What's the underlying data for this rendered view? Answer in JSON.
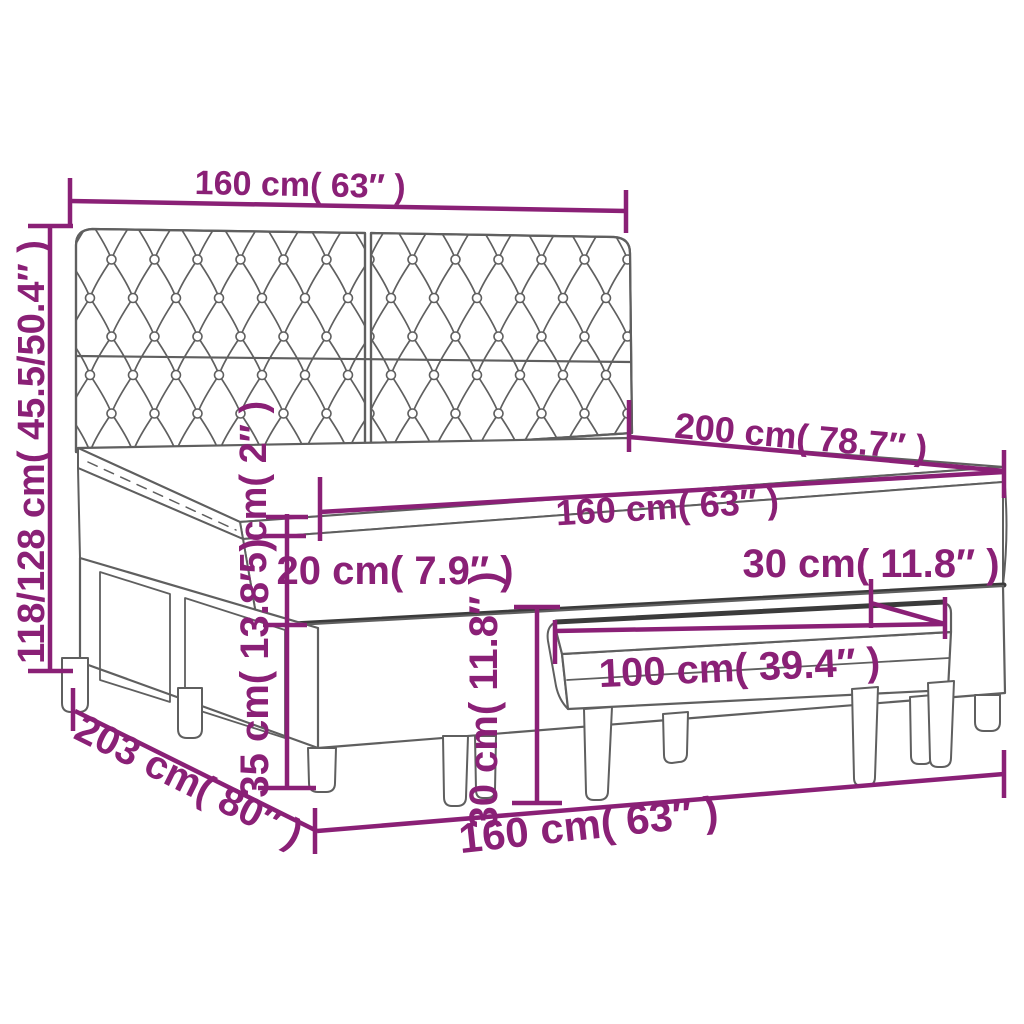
{
  "colors": {
    "dimension": "#8A2076",
    "outline": "#5f5f5f",
    "bold_edge": "#3b3b3b",
    "background": "#ffffff"
  },
  "labels": {
    "headboard_width": "160 cm( 63″ )",
    "bed_height": "118/128 cm( 45.5/50.4″ )",
    "bed_length": "200 cm( 78.7″ )",
    "mattress_width": "160 cm( 63″ )",
    "topper_thickness": "5 cm( 2″ )",
    "mattress_thickness": "20 cm( 7.9″ )",
    "base_leg_height": "35 cm( 13.8″ )",
    "bench_depth": "30 cm( 11.8″ )",
    "bench_width": "100 cm( 39.4″ )",
    "bench_height": "30 cm( 11.8″ )",
    "footprint_length": "203 cm( 80″ )",
    "footprint_width": "160 cm( 63″ )"
  }
}
